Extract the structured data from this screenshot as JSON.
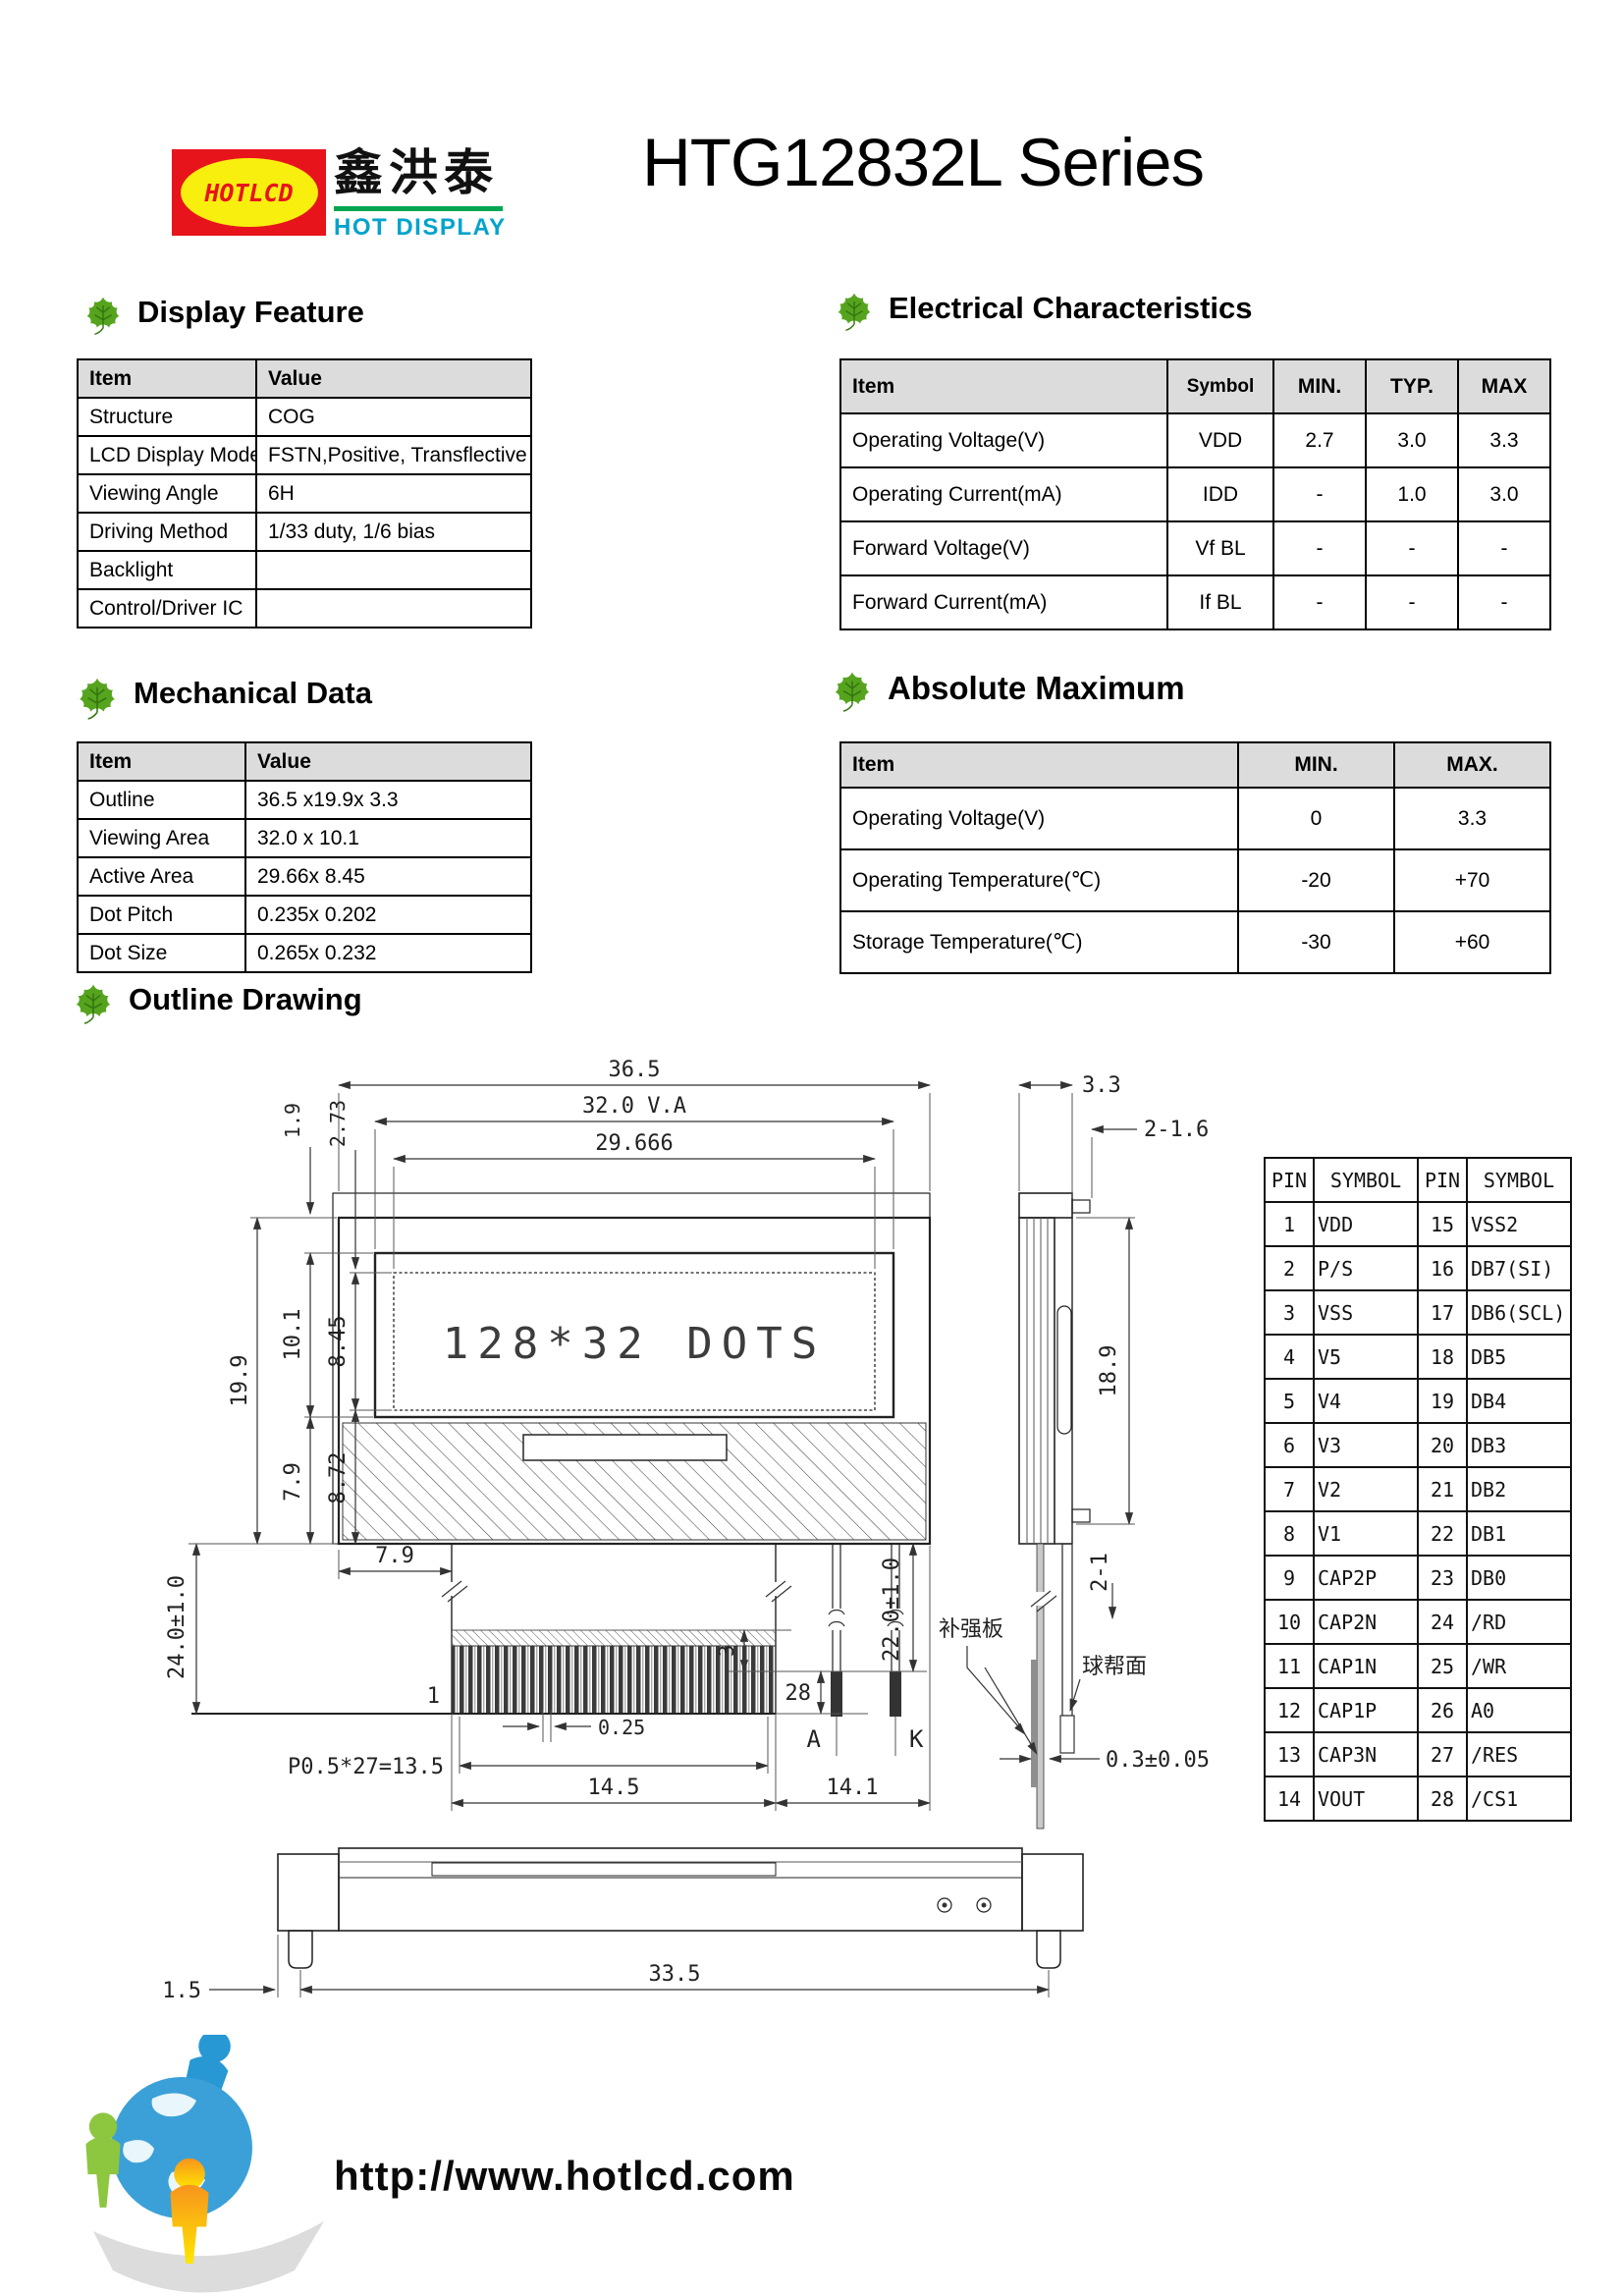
{
  "header": {
    "logo_badge_text": "HOTLCD",
    "logo_chinese": "鑫洪泰",
    "logo_subtitle": "HOT DISPLAY",
    "title": "HTG12832L Series",
    "brand_red": "#e8141c",
    "brand_yellow": "#f8ef0f",
    "brand_cyan": "#00a3cc",
    "brand_green": "#00a550"
  },
  "sections": {
    "display_feature": {
      "heading": "Display Feature",
      "columns": [
        "Item",
        "Value"
      ],
      "rows": [
        [
          "Structure",
          "COG"
        ],
        [
          "LCD Display Mode",
          "FSTN,Positive, Transflective"
        ],
        [
          "Viewing Angle",
          "6H"
        ],
        [
          "Driving Method",
          "1/33 duty, 1/6 bias"
        ],
        [
          "Backlight",
          ""
        ],
        [
          "Control/Driver IC",
          ""
        ]
      ]
    },
    "electrical": {
      "heading": "Electrical Characteristics",
      "columns": [
        "Item",
        "Symbol",
        "MIN.",
        "TYP.",
        "MAX"
      ],
      "rows": [
        [
          "Operating Voltage(V)",
          "VDD",
          "2.7",
          "3.0",
          "3.3"
        ],
        [
          "Operating Current(mA)",
          "IDD",
          "-",
          "1.0",
          "3.0"
        ],
        [
          "Forward Voltage(V)",
          "Vf BL",
          "-",
          "-",
          "-"
        ],
        [
          "Forward Current(mA)",
          "If BL",
          "-",
          "-",
          "-"
        ]
      ]
    },
    "mechanical": {
      "heading": "Mechanical Data",
      "columns": [
        "Item",
        "Value"
      ],
      "rows": [
        [
          "Outline",
          "36.5 x19.9x 3.3"
        ],
        [
          "Viewing Area",
          "32.0 x 10.1"
        ],
        [
          "Active Area",
          "29.66x 8.45"
        ],
        [
          "Dot Pitch",
          "0.235x 0.202"
        ],
        [
          "Dot Size",
          "0.265x 0.232"
        ]
      ]
    },
    "absolute_maximum": {
      "heading": "Absolute Maximum",
      "columns": [
        "Item",
        "MIN.",
        "MAX."
      ],
      "rows": [
        [
          "Operating Voltage(V)",
          "0",
          "3.3"
        ],
        [
          "Operating Temperature(℃)",
          "-20",
          "+70"
        ],
        [
          "Storage Temperature(℃)",
          "-30",
          "+60"
        ]
      ]
    },
    "outline_drawing": {
      "heading": "Outline Drawing"
    }
  },
  "drawing": {
    "display_text": "128*32 DOTS",
    "dims": {
      "total_width": "36.5",
      "va_width": "32.0  V.A",
      "active_width": "29.666",
      "edge_1_9": "1.9",
      "edge_2_73": "2.73",
      "total_height": "19.9",
      "va_height": "10.1",
      "active_height": "8.45",
      "lower_7_9": "7.9",
      "lower_8_72": "8.72",
      "fpc_length": "24.0±1.0",
      "fpc_offset": "7.9",
      "pin_first": "1",
      "finger_width": "0.25",
      "pitch": "P0.5*27=13.5",
      "fpc_width": "14.5",
      "led_width": "14.1",
      "tip_3": "3",
      "pin_last": "28",
      "led_length": "22.0±1.0",
      "anode": "A",
      "cathode": "K",
      "thickness": "3.3",
      "tab_2_16": "2-1.6",
      "side_height": "18.9",
      "tab_2_1": "2-1",
      "fpc_thickness": "0.3±0.05",
      "stiffener": "补强板",
      "solder_side": "球帮面",
      "foot_offset": "1.5",
      "foot_span": "33.5"
    },
    "pin_table": {
      "columns": [
        "PIN",
        "SYMBOL",
        "PIN",
        "SYMBOL"
      ],
      "rows": [
        [
          "1",
          "VDD",
          "15",
          "VSS2"
        ],
        [
          "2",
          "P/S",
          "16",
          "DB7(SI)"
        ],
        [
          "3",
          "VSS",
          "17",
          "DB6(SCL)"
        ],
        [
          "4",
          "V5",
          "18",
          "DB5"
        ],
        [
          "5",
          "V4",
          "19",
          "DB4"
        ],
        [
          "6",
          "V3",
          "20",
          "DB3"
        ],
        [
          "7",
          "V2",
          "21",
          "DB2"
        ],
        [
          "8",
          "V1",
          "22",
          "DB1"
        ],
        [
          "9",
          "CAP2P",
          "23",
          "DB0"
        ],
        [
          "10",
          "CAP2N",
          "24",
          "/RD"
        ],
        [
          "11",
          "CAP1N",
          "25",
          "/WR"
        ],
        [
          "12",
          "CAP1P",
          "26",
          "A0"
        ],
        [
          "13",
          "CAP3N",
          "27",
          "/RES"
        ],
        [
          "14",
          "VOUT",
          "28",
          "/CS1"
        ]
      ]
    }
  },
  "footer": {
    "url": "http://www.hotlcd.com"
  }
}
